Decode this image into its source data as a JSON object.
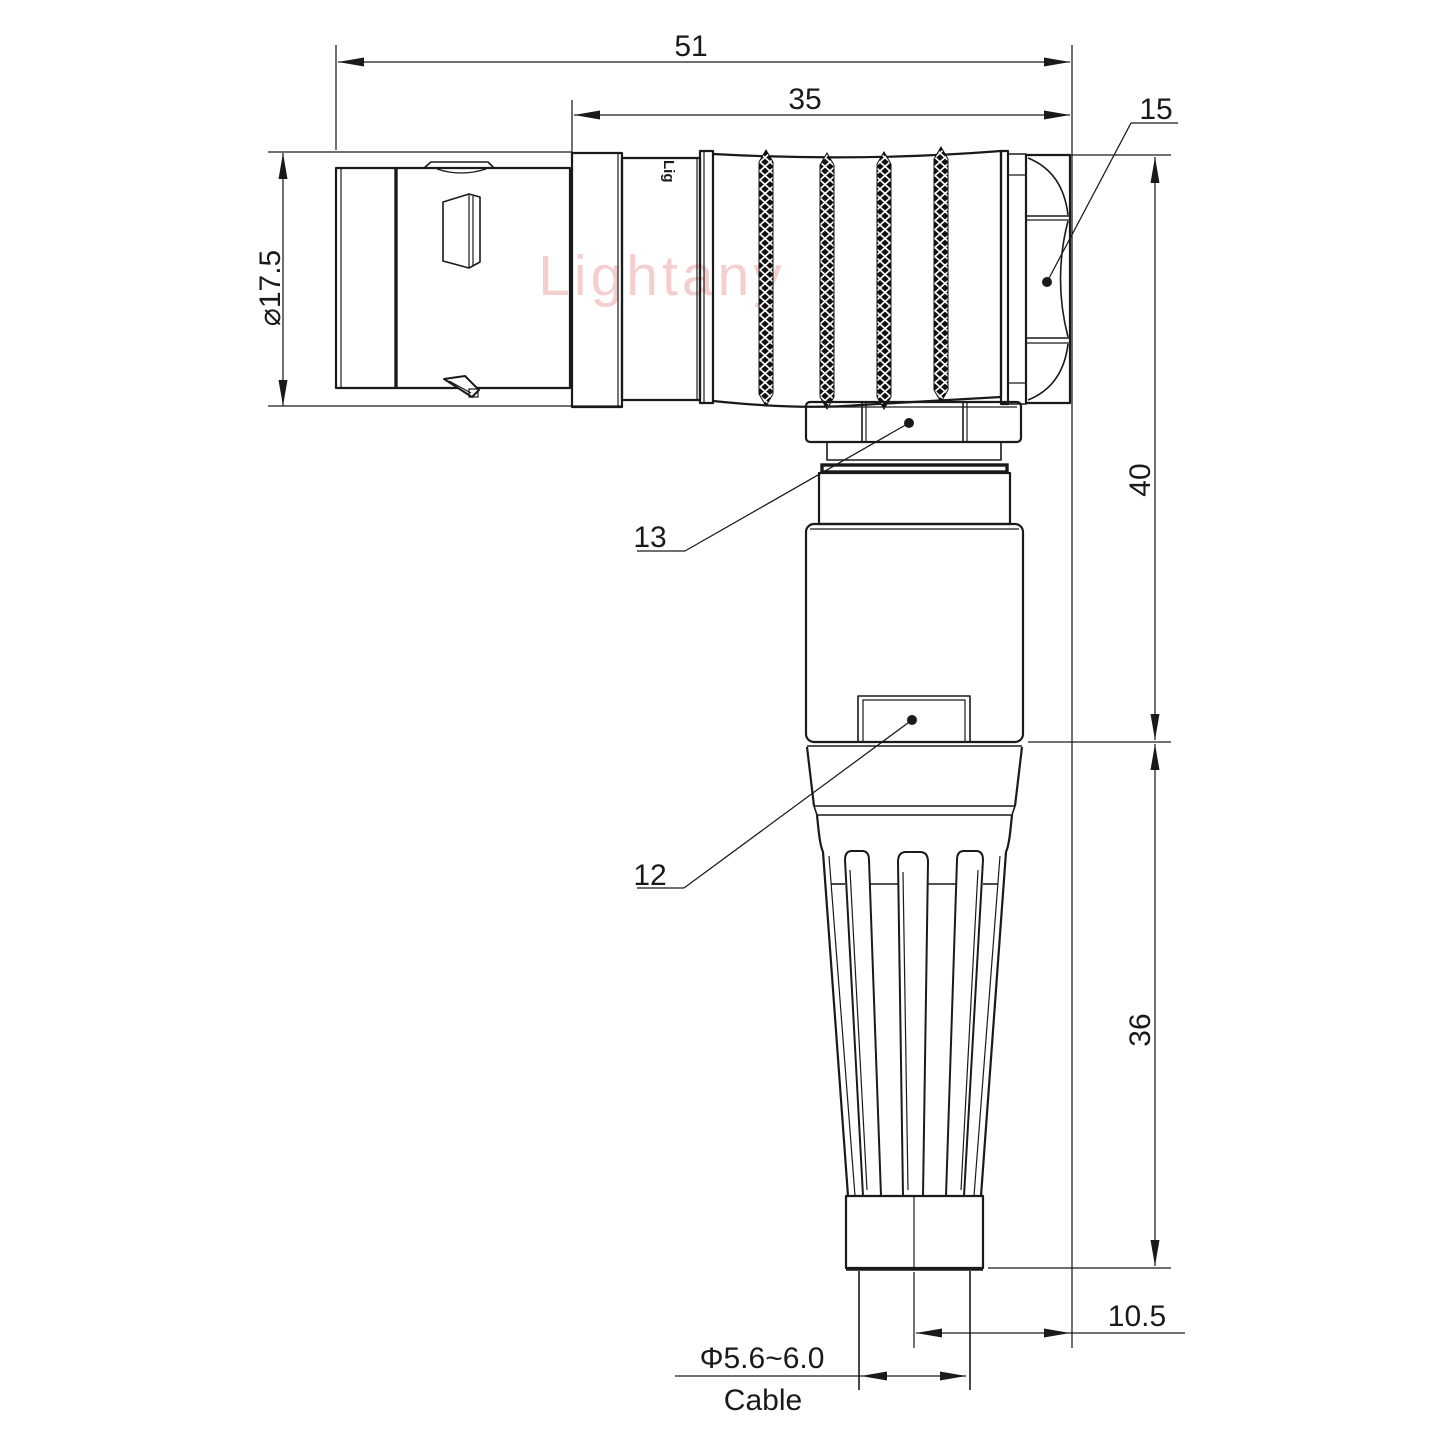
{
  "colors": {
    "line": "#1a1a1a",
    "watermark": "#f5cfcf",
    "background": "#ffffff"
  },
  "watermark": {
    "text": "Lightany"
  },
  "logo": {
    "text": "Lig"
  },
  "dimensions": {
    "overall_length": {
      "value": "51"
    },
    "body_length": {
      "value": "35"
    },
    "front_diameter": {
      "value": "⌀17.5"
    },
    "elbow_height": {
      "value": "40"
    },
    "boot_height": {
      "value": "36"
    },
    "cable_offset": {
      "value": "10.5"
    },
    "cable_diameter": {
      "value": "Φ5.6~6.0"
    },
    "cable_caption": {
      "value": "Cable"
    }
  },
  "part_labels": {
    "hex_nut": {
      "value": "15"
    },
    "clamp_nut": {
      "value": "13"
    },
    "latch": {
      "value": "12"
    }
  }
}
